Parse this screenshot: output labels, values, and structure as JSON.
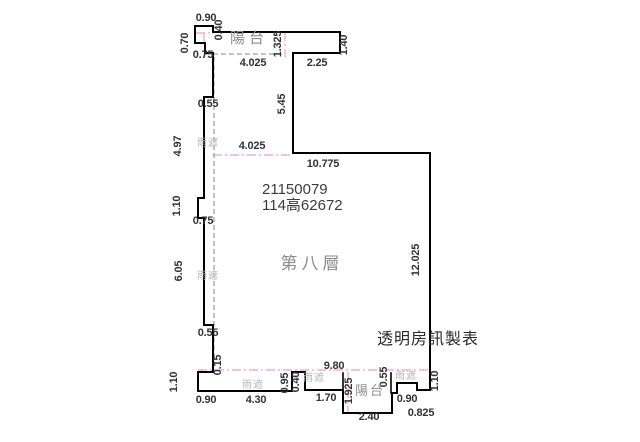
{
  "page": {
    "background": "#ffffff",
    "width": 640,
    "height": 442
  },
  "plan": {
    "floor_label": "第八層",
    "id_number": "21150079",
    "permit_number": "114高62672",
    "watermark": "透明房訊製表",
    "balcony_label": "陽台",
    "rain_shield_label": "雨遮",
    "colors": {
      "outline": "#000000",
      "dashed_gray": "#8a8a8a",
      "centerline_pink": "#f29ec6",
      "dimension_text": "#333333",
      "area_text": "#8c8c8c",
      "faint_text": "#b5b5b5"
    },
    "paths": {
      "main_outline": "M195,26 L213,26 L213,32 L340,32 L340,53 L293,53 L293,153 L430,153 L430,390 L417,390 L417,383 L397,383 L397,393 L392,393 L392,413 L343,413 L343,390 L305,390 L305,372 L292,372 L292,391 L198,391 L198,372 L213,372 L213,325 L204,325 L204,218 L198,218 L198,198 L204,198 L204,97 L213,97 L213,53 L205,53 L205,43 L195,43 Z",
      "extra_walls": [
        "M343,390 L343,373",
        "M391,393 L391,373"
      ],
      "dashed_gray": [
        "M205,54 L285,54",
        "M214,57 L214,370"
      ],
      "centerlines_pink": [
        "M196,33 L214,33",
        "M204,33 L204,44",
        "M285,32 L285,57",
        "M213,155 L293,155",
        "M198,370 L431,370",
        "M348,372 L348,412"
      ]
    },
    "labels": [
      {
        "t": "0.90",
        "x": 206,
        "y": 21,
        "r": 0,
        "c": "dim",
        "n": "dimension-label"
      },
      {
        "t": "0.40",
        "x": 222,
        "y": 30,
        "r": 1,
        "c": "dim",
        "n": "dimension-label"
      },
      {
        "t": "0.70",
        "x": 188,
        "y": 43,
        "r": 1,
        "c": "dim",
        "n": "dimension-label"
      },
      {
        "t": "0.75",
        "x": 203,
        "y": 58,
        "r": 0,
        "c": "dim",
        "n": "dimension-label"
      },
      {
        "t": "陽台",
        "x": 249,
        "y": 43,
        "r": 0,
        "c": "balcony",
        "n": "balcony-label-top"
      },
      {
        "t": "1.325",
        "x": 281,
        "y": 44,
        "r": 1,
        "c": "dim",
        "n": "dimension-label"
      },
      {
        "t": "1.40",
        "x": 347,
        "y": 45,
        "r": 1,
        "c": "dim",
        "n": "dimension-label"
      },
      {
        "t": "4.025",
        "x": 253,
        "y": 66,
        "r": 0,
        "c": "dim",
        "n": "dimension-label"
      },
      {
        "t": "2.25",
        "x": 317,
        "y": 66,
        "r": 0,
        "c": "dim",
        "n": "dimension-label"
      },
      {
        "t": "0.55",
        "x": 208,
        "y": 107,
        "r": 0,
        "c": "dim",
        "n": "dimension-label"
      },
      {
        "t": "5.45",
        "x": 285,
        "y": 104,
        "r": 1,
        "c": "dim",
        "n": "dimension-label"
      },
      {
        "t": "雨遮",
        "x": 208,
        "y": 146,
        "r": 0,
        "c": "rain",
        "n": "rain-shield-label"
      },
      {
        "t": "4.97",
        "x": 181,
        "y": 146,
        "r": 1,
        "c": "dim",
        "n": "dimension-label"
      },
      {
        "t": "4.025",
        "x": 252,
        "y": 149,
        "r": 0,
        "c": "dim",
        "n": "dimension-label"
      },
      {
        "t": "10.775",
        "x": 323,
        "y": 167,
        "r": 0,
        "c": "dim",
        "n": "dimension-label"
      },
      {
        "t": "21150079",
        "x": 262,
        "y": 194,
        "r": 0,
        "c": "id",
        "a": "start",
        "n": "plan-id-number"
      },
      {
        "t": "114高62672",
        "x": 262,
        "y": 210,
        "r": 0,
        "c": "id",
        "a": "start",
        "n": "plan-permit-number"
      },
      {
        "t": "1.10",
        "x": 180,
        "y": 206,
        "r": 1,
        "c": "dim",
        "n": "dimension-label"
      },
      {
        "t": "0.75",
        "x": 203,
        "y": 224,
        "r": 0,
        "c": "dim",
        "n": "dimension-label"
      },
      {
        "t": "第八層",
        "x": 312,
        "y": 269,
        "r": 0,
        "c": "area",
        "n": "floor-label"
      },
      {
        "t": "6.05",
        "x": 182,
        "y": 271,
        "r": 1,
        "c": "dim",
        "n": "dimension-label"
      },
      {
        "t": "雨遮",
        "x": 208,
        "y": 279,
        "r": 0,
        "c": "rain",
        "n": "rain-shield-label"
      },
      {
        "t": "12.025",
        "x": 419,
        "y": 260,
        "r": 1,
        "c": "dim",
        "n": "dimension-label"
      },
      {
        "t": "0.55",
        "x": 208,
        "y": 336,
        "r": 0,
        "c": "dim",
        "n": "dimension-label"
      },
      {
        "t": "透明房訊製表",
        "x": 428,
        "y": 344,
        "r": 0,
        "c": "watermark",
        "n": "watermark"
      },
      {
        "t": "0.15",
        "x": 221,
        "y": 365,
        "r": 1,
        "c": "dim",
        "n": "dimension-label"
      },
      {
        "t": "9.80",
        "x": 334,
        "y": 369,
        "r": 0,
        "c": "dim",
        "n": "dimension-label"
      },
      {
        "t": "1.10",
        "x": 177,
        "y": 382,
        "r": 1,
        "c": "dim",
        "n": "dimension-label"
      },
      {
        "t": "0.95",
        "x": 288,
        "y": 383,
        "r": 1,
        "c": "dim",
        "n": "dimension-label"
      },
      {
        "t": "0.40",
        "x": 299,
        "y": 382,
        "r": 1,
        "c": "dim",
        "n": "dimension-label"
      },
      {
        "t": "雨遮",
        "x": 314,
        "y": 381,
        "r": 0,
        "c": "rain",
        "n": "rain-shield-label"
      },
      {
        "t": "雨遮",
        "x": 253,
        "y": 388,
        "r": 0,
        "c": "rain",
        "n": "rain-shield-label"
      },
      {
        "t": "1.925",
        "x": 352,
        "y": 391,
        "r": 1,
        "c": "dim",
        "n": "dimension-label"
      },
      {
        "t": "陽台",
        "x": 370,
        "y": 395,
        "r": 0,
        "c": "balcony-sm",
        "n": "balcony-label-bottom"
      },
      {
        "t": "0.55",
        "x": 387,
        "y": 377,
        "r": 1,
        "c": "dim",
        "n": "dimension-label"
      },
      {
        "t": "雨遮",
        "x": 406,
        "y": 379,
        "r": 0,
        "c": "rain",
        "n": "rain-shield-label"
      },
      {
        "t": "1.10",
        "x": 438,
        "y": 381,
        "r": 1,
        "c": "dim",
        "n": "dimension-label"
      },
      {
        "t": "0.90",
        "x": 206,
        "y": 403,
        "r": 0,
        "c": "dim",
        "n": "dimension-label"
      },
      {
        "t": "4.30",
        "x": 256,
        "y": 403,
        "r": 0,
        "c": "dim",
        "n": "dimension-label"
      },
      {
        "t": "1.70",
        "x": 326,
        "y": 401,
        "r": 0,
        "c": "dim",
        "n": "dimension-label"
      },
      {
        "t": "0.90",
        "x": 407,
        "y": 402,
        "r": 0,
        "c": "dim",
        "n": "dimension-label"
      },
      {
        "t": "2.40",
        "x": 369,
        "y": 420,
        "r": 0,
        "c": "dim",
        "n": "dimension-label"
      },
      {
        "t": "0.825",
        "x": 421,
        "y": 416,
        "r": 0,
        "c": "dim",
        "n": "dimension-label"
      }
    ]
  }
}
